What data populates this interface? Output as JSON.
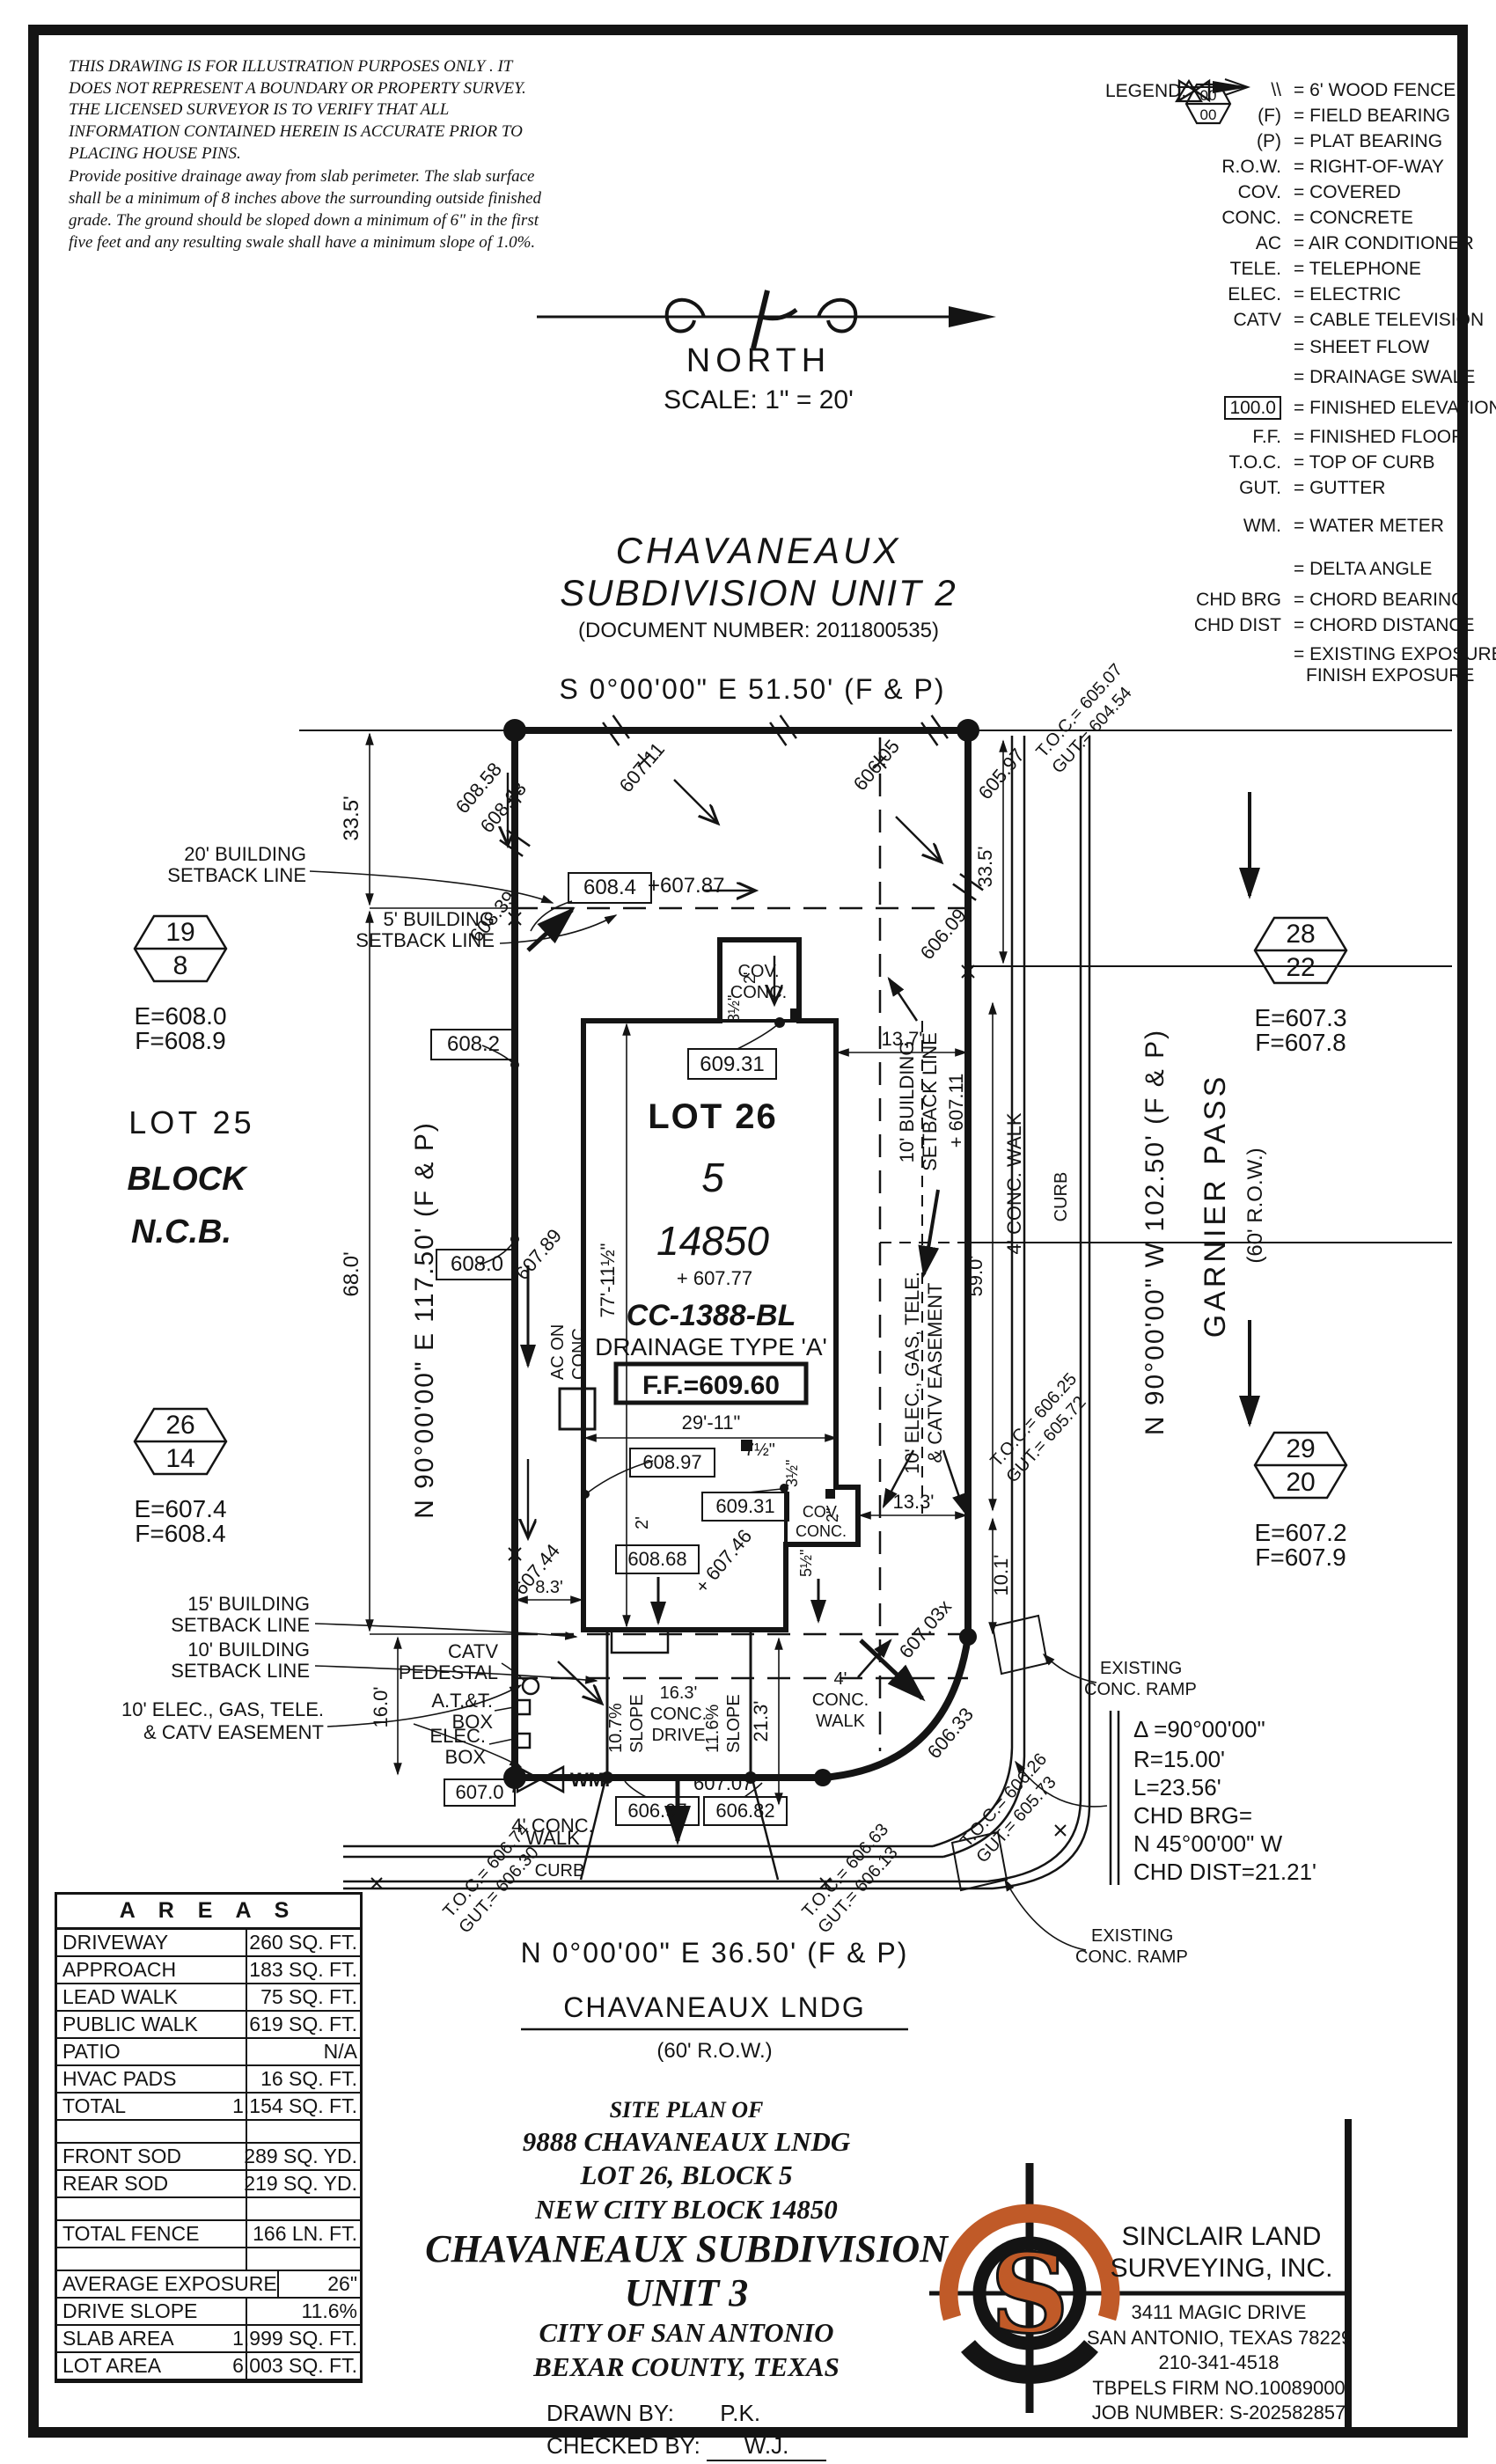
{
  "colors": {
    "ink": "#141414",
    "gray": "#9b9b9b",
    "orange": "#c05a28"
  },
  "disclaimer": {
    "p1": "THIS DRAWING IS FOR ILLUSTRATION PURPOSES ONLY . IT DOES NOT REPRESENT A BOUNDARY OR PROPERTY SURVEY. THE LICENSED SURVEYOR IS TO VERIFY THAT ALL INFORMATION CONTAINED HEREIN IS ACCURATE PRIOR TO PLACING HOUSE PINS.",
    "p2": "Provide positive drainage away from slab perimeter. The slab surface shall be a minimum of 8 inches above the surrounding outside finished grade. The ground should be sloped down a minimum of 6\" in the first five feet and any resulting swale shall have a minimum slope of 1.0%."
  },
  "legend": {
    "title": "LEGEND:",
    "items": [
      {
        "sym": "\\\\",
        "text": "= 6' WOOD FENCE"
      },
      {
        "sym": "(F)",
        "text": "= FIELD BEARING"
      },
      {
        "sym": "(P)",
        "text": "= PLAT BEARING"
      },
      {
        "sym": "R.O.W.",
        "text": "= RIGHT-OF-WAY"
      },
      {
        "sym": "COV.",
        "text": "= COVERED"
      },
      {
        "sym": "CONC.",
        "text": "= CONCRETE"
      },
      {
        "sym": "AC",
        "text": "= AIR CONDITIONER"
      },
      {
        "sym": "TELE.",
        "text": "= TELEPHONE"
      },
      {
        "sym": "ELEC.",
        "text": "= ELECTRIC"
      },
      {
        "sym": "CATV",
        "text": "= CABLE TELEVISION"
      },
      {
        "sym": "",
        "text": "= SHEET FLOW"
      },
      {
        "sym": "",
        "text": "= DRAINAGE SWALE"
      },
      {
        "sym": "100.0",
        "text": "= FINISHED ELEVATION"
      },
      {
        "sym": "F.F.",
        "text": "= FINISHED FLOOR"
      },
      {
        "sym": "T.O.C.",
        "text": "= TOP OF CURB"
      },
      {
        "sym": "GUT.",
        "text": "= GUTTER"
      },
      {
        "sym": "WM.",
        "text": "= WATER METER"
      },
      {
        "sym": "",
        "text": "= DELTA ANGLE"
      },
      {
        "sym": "CHD BRG",
        "text": "= CHORD BEARING"
      },
      {
        "sym": "CHD DIST",
        "text": "= CHORD DISTANCE"
      },
      {
        "sym_top": "00",
        "sym_bottom": "00",
        "text1": "= EXISTING EXPOSURE",
        "text2": "FINISH EXPOSURE"
      }
    ]
  },
  "north": {
    "label": "NORTH",
    "scale": "SCALE: 1\" = 20'"
  },
  "subheading": {
    "line1": "CHAVANEAUX",
    "line2": "SUBDIVISION UNIT 2",
    "doc": "(DOCUMENT NUMBER: 2011800535)"
  },
  "plan": {
    "bearing_top": "S 0°00'00\" E 51.50' (F & P)",
    "bearing_left": "N 90°00'00\" E 117.50' (F & P)",
    "bearing_right": "N 90°00'00\" W 102.50' (F & P)",
    "bearing_bottom": "N 0°00'00\" E 36.50' (F & P)",
    "street_right": "GARNIER PASS",
    "row_right": "(60' R.O.W.)",
    "street_bottom": "CHAVANEAUX LNDG",
    "row_bottom": "(60' R.O.W.)",
    "adj": {
      "lot": "LOT 25",
      "block": "BLOCK",
      "ncb": "N.C.B."
    },
    "lot": {
      "name": "LOT 26",
      "block": "5",
      "ncb": "14850",
      "spot": "+ 607.77",
      "cc": "CC-1388-BL",
      "drainage": "DRAINAGE TYPE 'A'",
      "ff": "F.F.=609.60",
      "w": "29'-11\"",
      "h": "77'-11½\""
    },
    "sb": {
      "a1": "20' BUILDING",
      "a2": "SETBACK LINE",
      "b1": "5' BUILDING",
      "b2": "SETBACK LINE",
      "c1": "15' BUILDING",
      "c2": "SETBACK LINE",
      "d1": "10' BUILDING",
      "d2": "SETBACK LINE",
      "r1": "10' BUILDING",
      "r2": "SETBACK LINE"
    },
    "ease": {
      "l1": "10' ELEC., GAS, TELE.",
      "l2": "& CATV EASEMENT",
      "r1": "10' ELEC., GAS, TELE.",
      "r2": "& CATV EASEMENT"
    },
    "dims": {
      "a": "33.5'",
      "b": "33.5'",
      "c": "68.0'",
      "d": "16.0'",
      "e": "13.7'",
      "f": "13.3'",
      "g": "59.0'",
      "h": "10.1'",
      "i": "21.3'",
      "j": "8.3'",
      "k": "2'",
      "l": "2'",
      "m": "2\"",
      "n": "3½\"",
      "o": "3½\"",
      "p": "5½\"",
      "q": "7½\""
    },
    "drive": {
      "a": "16.3'",
      "b": "CONC.",
      "c": "DRIVE",
      "s1": "10.7%",
      "s2": "SLOPE",
      "s3": "11.6%",
      "s4": "SLOPE"
    },
    "walk": {
      "r": "4' CONC. WALK",
      "rcurb": "CURB",
      "b1": "4' CONC.",
      "b2": "WALK",
      "bcurb": "CURB",
      "m1": "4'",
      "m2": "CONC.",
      "m3": "WALK"
    },
    "spots": {
      "a": "608.58",
      "b": "608.68",
      "c": "608.39",
      "d": "607.11",
      "e": "606.05",
      "f": "605.97",
      "g": "606.09",
      "h": "+607.87",
      "i": "607.89",
      "j": "607.44",
      "k": "+ 607.46",
      "l": "607.03x",
      "m": "606.33",
      "n": "607.07",
      "o": "+ 607.11"
    },
    "boxes": {
      "a": "608.4",
      "b": "608.2",
      "c": "608.0",
      "d": "609.31",
      "e": "609.31",
      "f": "608.97",
      "g": "608.68",
      "h": "607.0",
      "i": "606.97",
      "j": "606.82"
    },
    "toc": {
      "a1": "T.O.C.= 605.07",
      "a2": "GUT.= 604.54",
      "b1": "T.O.C.= 606.74",
      "b2": "GUT.= 606.30",
      "c1": "T.O.C.= 606.63",
      "c2": "GUT.= 606.13",
      "d1": "T.O.C.= 606.26",
      "d2": "GUT.= 605.73",
      "e1": "T.O.C.= 606.25",
      "e2": "GUT.= 605.72"
    },
    "utils": {
      "catv1": "CATV",
      "catv2": "PEDESTAL",
      "att1": "A.T.&T.",
      "att2": "BOX",
      "el1": "ELEC.",
      "el2": "BOX",
      "wm": "WM.",
      "ac1": "AC ON",
      "ac2": "CONC.",
      "cov1": "COV.",
      "cov2": "CONC.",
      "cov3": "COV.",
      "cov4": "CONC.",
      "ramp1": "EXISTING",
      "ramp2": "CONC. RAMP",
      "ramp3": "EXISTING",
      "ramp4": "CONC. RAMP"
    },
    "curve": {
      "d": "Δ =90°00'00\"",
      "r": "R=15.00'",
      "l": "L=23.56'",
      "c1": "CHD BRG=",
      "c2": "N 45°00'00\" W",
      "c3": "CHD DIST=21.21'"
    },
    "mk": {
      "a1": "19",
      "a2": "8",
      "ae": "E=608.0",
      "af": "F=608.9",
      "b1": "28",
      "b2": "22",
      "be": "E=607.3",
      "bf": "F=607.8",
      "c1": "26",
      "c2": "14",
      "ce": "E=607.4",
      "cf": "F=608.4",
      "d1": "29",
      "d2": "20",
      "de": "E=607.2",
      "df": "F=607.9"
    }
  },
  "areas": {
    "title": "A R E A S",
    "rows": [
      {
        "label": "DRIVEWAY",
        "value": "260 SQ. FT."
      },
      {
        "label": "APPROACH",
        "value": "183 SQ. FT."
      },
      {
        "label": "LEAD WALK",
        "value": "75 SQ. FT."
      },
      {
        "label": "PUBLIC WALK",
        "value": "619 SQ. FT."
      },
      {
        "label": "PATIO",
        "value": "N/A"
      },
      {
        "label": "HVAC PADS",
        "value": "16 SQ. FT."
      },
      {
        "label": "TOTAL",
        "value": "1,154 SQ. FT."
      },
      {
        "label": "",
        "value": ""
      },
      {
        "label": "FRONT SOD",
        "value": "289 SQ. YD."
      },
      {
        "label": "REAR SOD",
        "value": "219 SQ. YD."
      },
      {
        "label": "",
        "value": ""
      },
      {
        "label": "TOTAL FENCE",
        "value": "166 LN. FT."
      },
      {
        "label": "",
        "value": ""
      },
      {
        "label": "AVERAGE EXPOSURE",
        "value": "26\""
      },
      {
        "label": "DRIVE SLOPE",
        "value": "11.6%"
      },
      {
        "label": "SLAB AREA",
        "value": "1,999 SQ. FT."
      },
      {
        "label": "LOT AREA",
        "value": "6,003 SQ. FT."
      }
    ]
  },
  "titleblock": {
    "l1": "SITE PLAN OF",
    "l2": "9888 CHAVANEAUX LNDG",
    "l3": "LOT 26, BLOCK 5",
    "l4": "NEW CITY BLOCK 14850",
    "l5": "CHAVANEAUX SUBDIVISION",
    "l6": "UNIT 3",
    "l7": "CITY OF SAN ANTONIO",
    "l8": "BEXAR COUNTY, TEXAS",
    "drawn_label": "DRAWN BY:",
    "drawn": "P.K.",
    "checked_label": "CHECKED BY:",
    "checked": "W.J.",
    "date_label": "DATE:",
    "date": "7/29/2025"
  },
  "company": {
    "name1": "SINCLAIR LAND",
    "name2": "SURVEYING, INC.",
    "addr1": "3411 MAGIC DRIVE",
    "addr2": "SAN ANTONIO, TEXAS 78229",
    "phone": "210-341-4518",
    "firm": "TBPELS FIRM NO.10089000",
    "job": "JOB NUMBER: S-202582857",
    "logo_letter": "S"
  }
}
